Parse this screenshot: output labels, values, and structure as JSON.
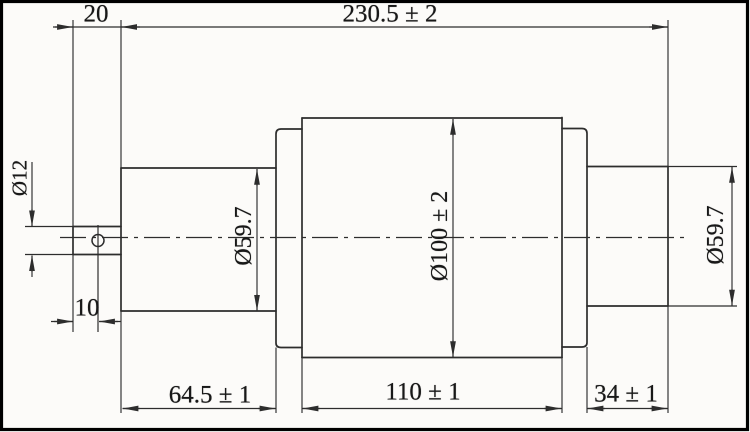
{
  "drawing": {
    "dimensions": {
      "offset_20": "20",
      "overall_length": "230.5 ± 2",
      "stub_diameter": "Ø12",
      "hole_offset": "10",
      "left_neck_diameter": "Ø59.7",
      "body_diameter": "Ø100 ± 2",
      "right_neck_diameter": "Ø59.7",
      "left_neck_length": "64.5 ± 1",
      "body_length": "110 ± 1",
      "right_neck_length": "34 ± 1"
    },
    "colors": {
      "background": "#fcfbf9",
      "line": "#2d2d2d",
      "text": "#181818",
      "frame": "#000000"
    }
  }
}
